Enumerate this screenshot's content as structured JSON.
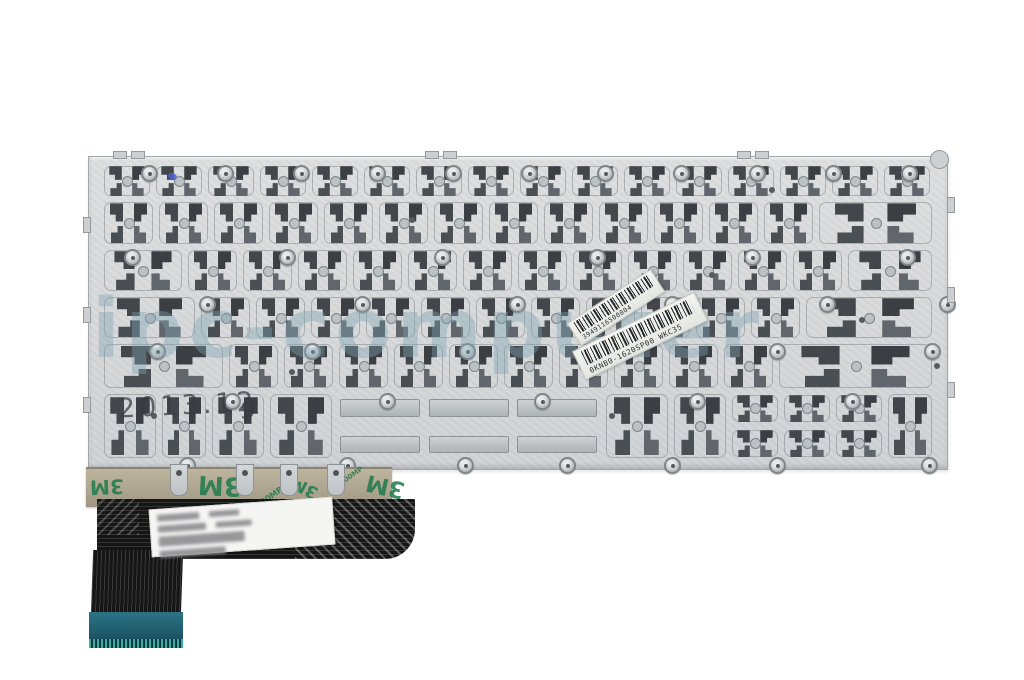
{
  "photo": {
    "description": "back side of a laptop keyboard replacement part",
    "watermark": "ipc-computer",
    "stamp_date": "2013.12",
    "stamp_digit": "9",
    "stickers": [
      {
        "code": "3949116500004"
      },
      {
        "code": "0KNB0-1620SP00 WKC35"
      }
    ],
    "tape": {
      "brand": "3M",
      "adhesive_code": "200MP",
      "logos": [
        {
          "use": "brand",
          "l": 4,
          "t": 6,
          "s": 20,
          "r": 178
        },
        {
          "use": "brand",
          "l": 112,
          "t": 1,
          "s": 26,
          "r": 183
        },
        {
          "use": "brand",
          "l": 204,
          "t": 8,
          "s": 17,
          "r": 208
        },
        {
          "use": "brand",
          "l": 280,
          "t": 4,
          "s": 23,
          "r": 193
        },
        {
          "use": "adhesive_code",
          "l": 168,
          "t": 24,
          "s": 8,
          "r": -35
        },
        {
          "use": "adhesive_code",
          "l": 252,
          "t": 3,
          "s": 7,
          "r": -35
        }
      ]
    },
    "colors": {
      "plate": "#d6d8da",
      "latch_dark": "#43474b",
      "tape": "#ada490",
      "tape_logo_green": "#1f7a4d",
      "cable_black": "#151515",
      "connector_teal": "#1c5565",
      "watermark_blue": "rgba(125,162,178,0.40)",
      "background": "#ffffff"
    }
  },
  "plate": {
    "rows": [
      {
        "top": 6,
        "h": 36,
        "cells": [
          52,
          52,
          52,
          52,
          52,
          52,
          52,
          52,
          52,
          52,
          52,
          52,
          52,
          52,
          52,
          52
        ]
      },
      {
        "top": 42,
        "h": 48,
        "cells": [
          55,
          55,
          55,
          55,
          55,
          55,
          55,
          55,
          55,
          55,
          55,
          55,
          55,
          119
        ]
      },
      {
        "top": 90,
        "h": 47,
        "cells": [
          84,
          55,
          55,
          55,
          55,
          55,
          55,
          55,
          55,
          55,
          55,
          55,
          55,
          90
        ]
      },
      {
        "top": 137,
        "h": 47,
        "cells": [
          97,
          55,
          55,
          55,
          55,
          55,
          55,
          55,
          55,
          55,
          55,
          55,
          132
        ]
      },
      {
        "top": 184,
        "h": 50,
        "cells": [
          125,
          55,
          55,
          55,
          55,
          55,
          55,
          55,
          55,
          55,
          55,
          159
        ]
      },
      {
        "top": 234,
        "h": 70,
        "cells": [
          58,
          50,
          58,
          68,
          {
            "w": 268,
            "t": "space"
          },
          68,
          58,
          {
            "w": 52,
            "t": "arrows"
          },
          {
            "w": 52,
            "t": "arrows"
          },
          {
            "w": 52,
            "t": "arrows"
          },
          50
        ]
      }
    ],
    "screws": [
      [
        52,
        8
      ],
      [
        128,
        8
      ],
      [
        204,
        8
      ],
      [
        280,
        8
      ],
      [
        356,
        8
      ],
      [
        432,
        8
      ],
      [
        508,
        8
      ],
      [
        584,
        8
      ],
      [
        660,
        8
      ],
      [
        736,
        8
      ],
      [
        812,
        8
      ],
      [
        35,
        92
      ],
      [
        190,
        92
      ],
      [
        345,
        92
      ],
      [
        500,
        92
      ],
      [
        655,
        92
      ],
      [
        810,
        92
      ],
      [
        110,
        139
      ],
      [
        265,
        139
      ],
      [
        420,
        139
      ],
      [
        575,
        139
      ],
      [
        730,
        139
      ],
      [
        850,
        139
      ],
      [
        60,
        186
      ],
      [
        215,
        186
      ],
      [
        370,
        186
      ],
      [
        525,
        186
      ],
      [
        680,
        186
      ],
      [
        835,
        186
      ],
      [
        135,
        236
      ],
      [
        290,
        236
      ],
      [
        445,
        236
      ],
      [
        600,
        236
      ],
      [
        755,
        236
      ],
      [
        90,
        300
      ],
      [
        250,
        300
      ],
      [
        368,
        300
      ],
      [
        470,
        300
      ],
      [
        575,
        300
      ],
      [
        680,
        300
      ],
      [
        832,
        300
      ]
    ],
    "rivets": [
      [
        320,
        60
      ],
      [
        620,
        115
      ],
      [
        770,
        160
      ],
      [
        200,
        212
      ],
      [
        520,
        256
      ],
      [
        845,
        206
      ],
      [
        62,
        256
      ],
      [
        680,
        30
      ]
    ],
    "edge_tabs": [
      {
        "l": 24,
        "t": -6,
        "w": 12,
        "h": 6
      },
      {
        "l": 42,
        "t": -6,
        "w": 12,
        "h": 6
      },
      {
        "l": 336,
        "t": -6,
        "w": 12,
        "h": 6
      },
      {
        "l": 354,
        "t": -6,
        "w": 12,
        "h": 6
      },
      {
        "l": 648,
        "t": -6,
        "w": 12,
        "h": 6
      },
      {
        "l": 666,
        "t": -6,
        "w": 12,
        "h": 6
      },
      {
        "l": -6,
        "t": 60,
        "w": 6,
        "h": 14
      },
      {
        "l": -6,
        "t": 150,
        "w": 6,
        "h": 14
      },
      {
        "l": -6,
        "t": 240,
        "w": 6,
        "h": 14
      },
      {
        "l": 858,
        "t": 40,
        "w": 6,
        "h": 14
      },
      {
        "l": 858,
        "t": 130,
        "w": 6,
        "h": 14
      },
      {
        "l": 858,
        "t": 225,
        "w": 6,
        "h": 14
      }
    ],
    "hang_tabs_x": [
      170,
      236,
      280,
      327
    ],
    "label_lines": [
      [
        [
          42,
          7
        ],
        [
          30,
          6
        ]
      ],
      [
        [
          48,
          7
        ],
        [
          36,
          6
        ]
      ],
      [
        [
          86,
          10
        ]
      ],
      [
        [
          66,
          7
        ]
      ]
    ]
  }
}
